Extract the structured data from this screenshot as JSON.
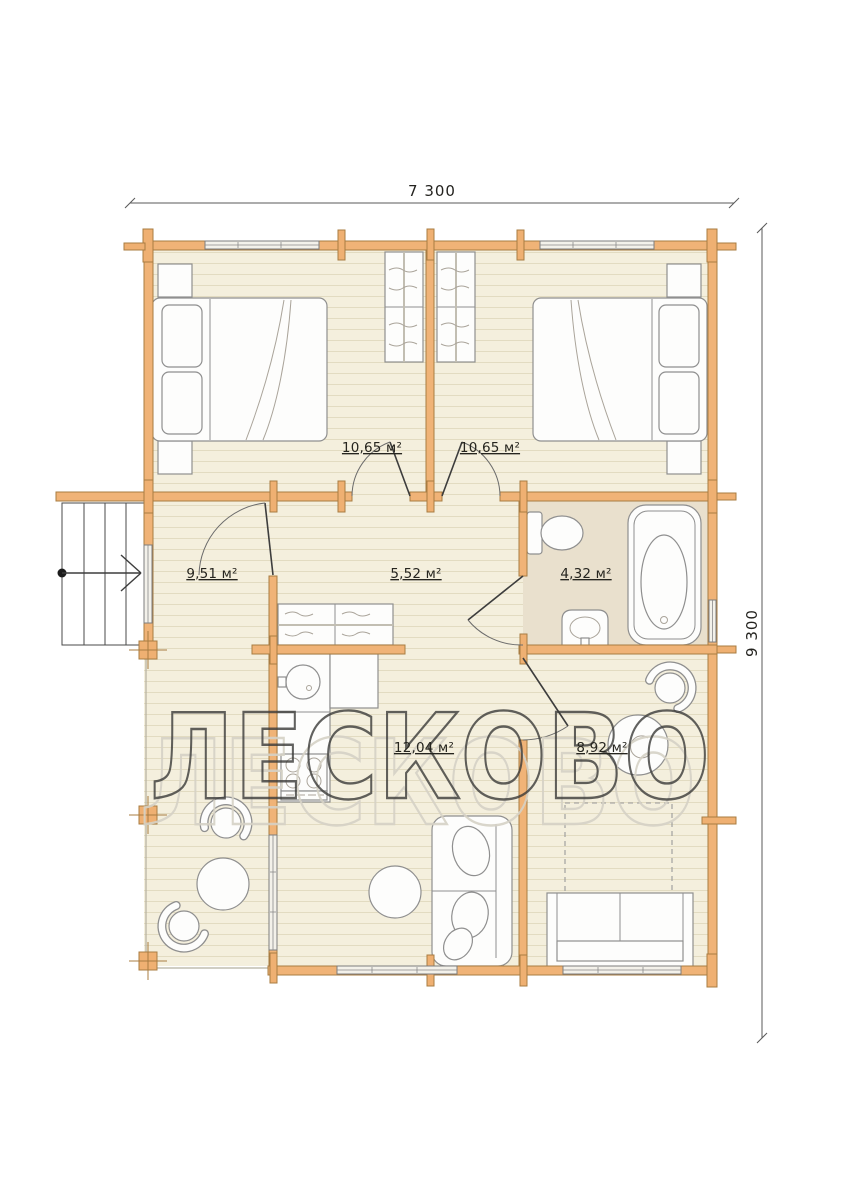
{
  "plan": {
    "watermark": "ЛЕСКОВО",
    "dimensions": {
      "width_label": "7 300",
      "height_label": "9 300"
    },
    "rooms": {
      "bedroom_left": {
        "area_label": "10,65 м²"
      },
      "bedroom_right": {
        "area_label": "10,65 м²"
      },
      "hallway": {
        "area_label": "9,51 м²"
      },
      "corridor": {
        "area_label": "5,52 м²"
      },
      "bathroom": {
        "area_label": "4,32 м²"
      },
      "kitchen_dining": {
        "area_label": "12,04 м²"
      },
      "living_room": {
        "area_label": "8,92 м²"
      }
    },
    "colors": {
      "wall": "#f0b377",
      "wall_outline": "#a87c42",
      "floor": "#f4efdd",
      "floor_stripe": "#e2dbc1",
      "bathroom_floor": "#e9e0cd",
      "furniture_outline": "#8f8f8f",
      "watermark_dark": "#3b3b39",
      "watermark_light": "#d6d2c6"
    }
  }
}
